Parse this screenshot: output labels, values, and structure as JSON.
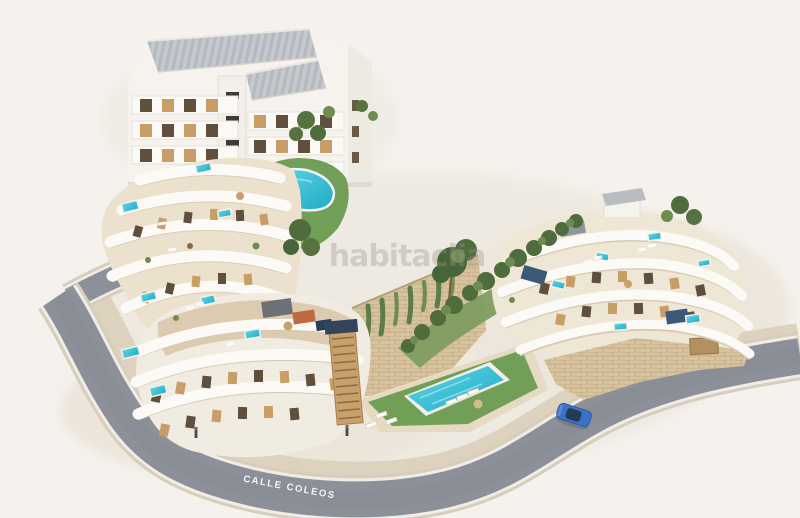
{
  "scene": {
    "description": "Aerial 3D architectural render of a hillside residential complex with terraced apartment buildings, rooftop plunge pools, communal swimming pools, landscaped gardens and a curving street",
    "watermark": "habitaclia",
    "street_label": "CALLE COLEOS",
    "objects": [
      "top-apartment-building",
      "upper-garden-pool",
      "left-terraced-building",
      "lower-left-terraced-building",
      "right-terraced-building",
      "communal-pool",
      "stone-retaining-wall",
      "hillside-trees",
      "street",
      "blue-car",
      "pedestrians"
    ],
    "colors": {
      "background": "#f5f2ee",
      "road_asphalt": "#8d9099",
      "road_curb": "#d8cdbb",
      "road_edge_line": "#f0ede6",
      "sidewalk": "#ddd2bd",
      "building_white": "#f6f3ee",
      "terrace_beige": "#dccbb0",
      "stone": "#d7c3a0",
      "wood": "#c89e66",
      "window_dark": "#5f4f3c",
      "roof_gray": "#c5c8cd",
      "lawn": "#729f57",
      "tree": "#4e6c3c",
      "pool": "#3cc5d8",
      "pergola_blue": "#3c5a77",
      "car": "#3a72c8",
      "watermark_gray": "#9a948b",
      "label_white": "#ffffff"
    }
  }
}
